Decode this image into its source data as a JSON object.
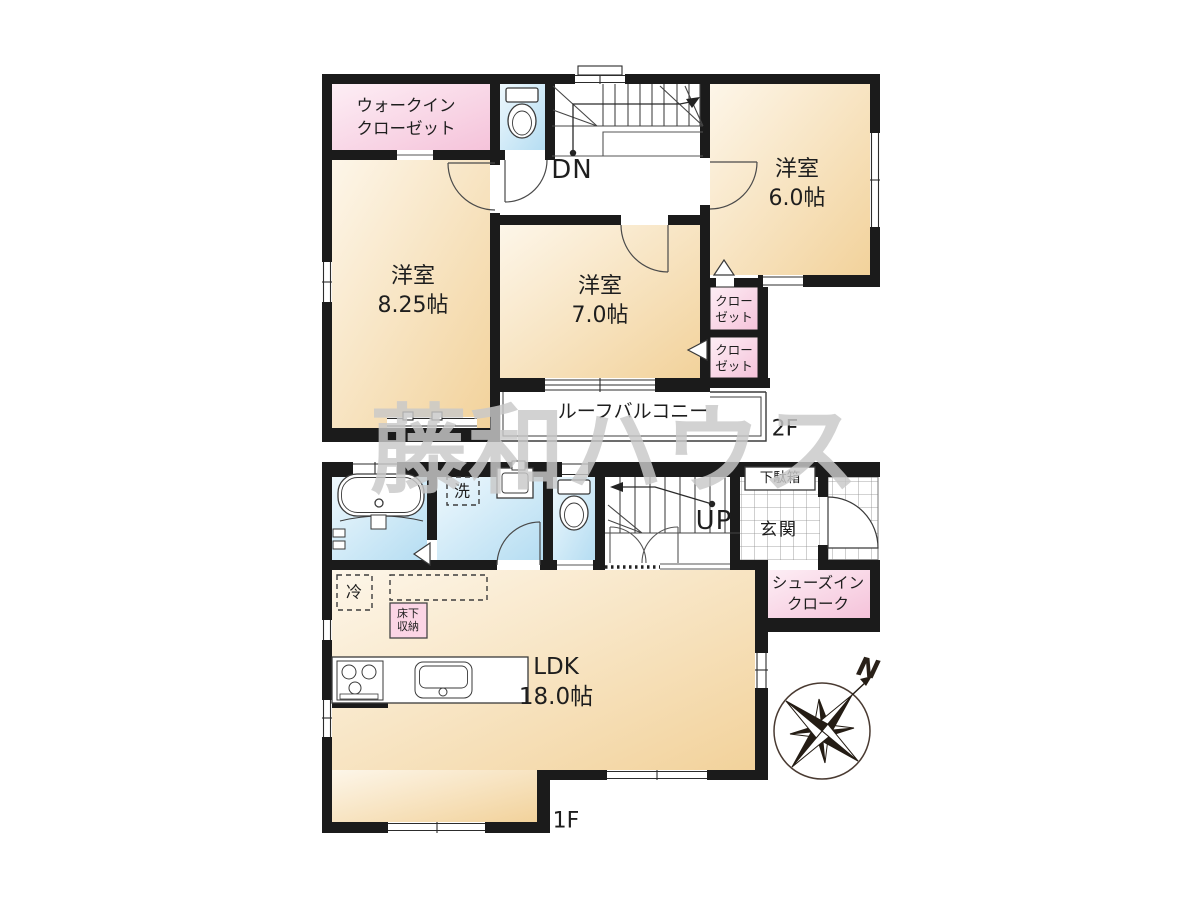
{
  "title": "間取り図",
  "floor2": {
    "rooms": {
      "wic": "ウォークイン\nクローゼット",
      "room_825": "洋室\n8.25帖",
      "room_70": "洋室\n7.0帖",
      "room_60": "洋室\n6.0帖",
      "closet_upper": "クロー\nゼット",
      "closet_lower": "クロー\nゼット",
      "balcony": "ルーフバルコニー"
    },
    "stairs_down_label": "DN",
    "floor_label": "2F"
  },
  "floor1": {
    "rooms": {
      "laundry": "洗",
      "fridge": "冷",
      "underfloor_storage": "床下\n収納",
      "shoe_cabinet": "下駄箱",
      "entrance": "玄関",
      "shoes_in_closet": "シューズイン\nクローク",
      "ldk": "LDK\n18.0帖"
    },
    "stairs_up_label": "UP",
    "floor_label": "1F"
  },
  "compass": {
    "north_label": "N"
  },
  "watermark": {
    "text": "藤和ハウス"
  },
  "colors": {
    "wall": "#1b1b1b",
    "room_fill": "#f5d9a8",
    "closet_pink": "#f7cade",
    "wet_area_blue": "#cfe9f7",
    "watermark_gray": "#c9c9c9"
  }
}
